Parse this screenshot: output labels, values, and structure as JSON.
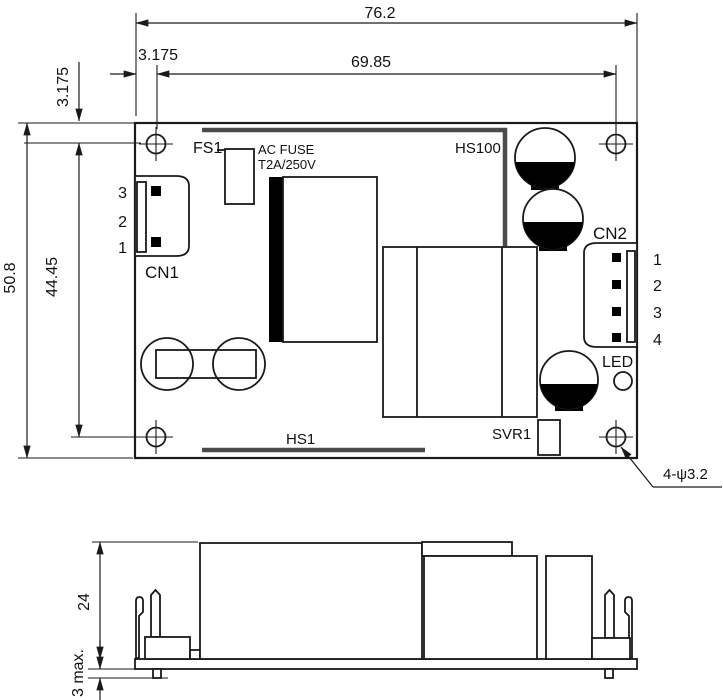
{
  "drawing": {
    "colors": {
      "line": "#1a1a1a",
      "heatsink": "#4a4a4a",
      "component_black": "#000000",
      "background": "#ffffff"
    },
    "top_view": {
      "labels": {
        "fs1": "FS1",
        "fuse_line1": "AC FUSE",
        "fuse_line2": "T2A/250V",
        "hs100": "HS100",
        "hs1": "HS1",
        "cn1": "CN1",
        "cn2": "CN2",
        "led": "LED",
        "svr1": "SVR1",
        "hole_note": "4-ψ3.2"
      },
      "cn1_pins": [
        "3",
        "2",
        "1"
      ],
      "cn2_pins": [
        "1",
        "2",
        "3",
        "4"
      ],
      "dimensions": {
        "total_width": "76.2",
        "hole_span_x": "69.85",
        "hole_offset_x": "3.175",
        "hole_offset_y": "3.175",
        "total_height": "50.8",
        "hole_span_y": "44.45"
      }
    },
    "side_view": {
      "dimensions": {
        "component_height": "24",
        "lead_protrusion": "3 max."
      }
    }
  }
}
